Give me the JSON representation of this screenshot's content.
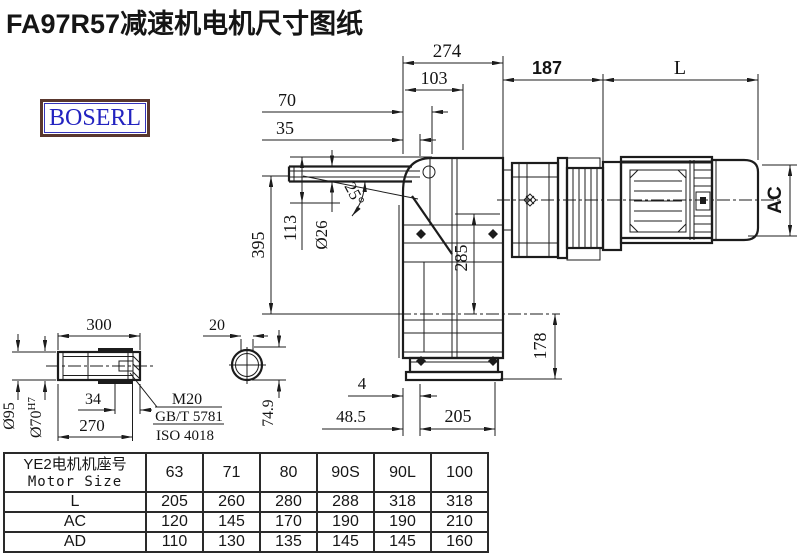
{
  "title": "FA97R57减速机电机尺寸图纸",
  "logo": "BOSERL",
  "dims": {
    "w274": "274",
    "w103": "103",
    "w70": "70",
    "w35": "35",
    "w187": "187",
    "wL": "L",
    "ac": "AC",
    "h395": "395",
    "h113": "113",
    "d26": "Ø26",
    "ang25": "25°",
    "h285": "285",
    "h178": "178",
    "b4": "4",
    "b48": "48.5",
    "b205": "205",
    "s300": "300",
    "s270": "270",
    "s34": "34",
    "d95": "Ø95",
    "d70": "Ø70",
    "d70tol": "H7",
    "m20": "M20",
    "gbt": "GB/T 5781",
    "iso": "ISO 4018",
    "k20": "20",
    "k749": "74.9"
  },
  "table": {
    "header_cn": "YE2电机机座号",
    "header_en": "Motor Size",
    "sizes": [
      "63",
      "71",
      "80",
      "90S",
      "90L",
      "100"
    ],
    "rows": [
      {
        "label": "L",
        "values": [
          "205",
          "260",
          "280",
          "288",
          "318",
          "318"
        ]
      },
      {
        "label": "AC",
        "values": [
          "120",
          "145",
          "170",
          "190",
          "190",
          "210"
        ]
      },
      {
        "label": "AD",
        "values": [
          "110",
          "130",
          "135",
          "145",
          "145",
          "160"
        ]
      }
    ]
  }
}
